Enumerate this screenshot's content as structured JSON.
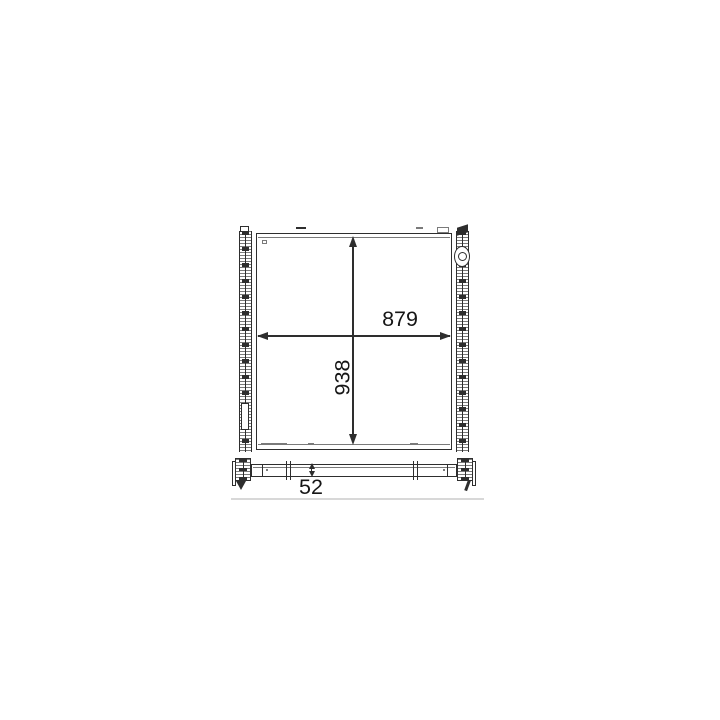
{
  "drawing": {
    "dimensions": {
      "core_width": {
        "value": "879"
      },
      "core_height": {
        "value": "938"
      },
      "core_depth": {
        "value": "52"
      }
    },
    "colors": {
      "line": "#2e2e2e",
      "line_soft": "#7a7a7a",
      "text": "#161616",
      "background": "#ffffff",
      "baseline": "#d8d8d8"
    }
  }
}
